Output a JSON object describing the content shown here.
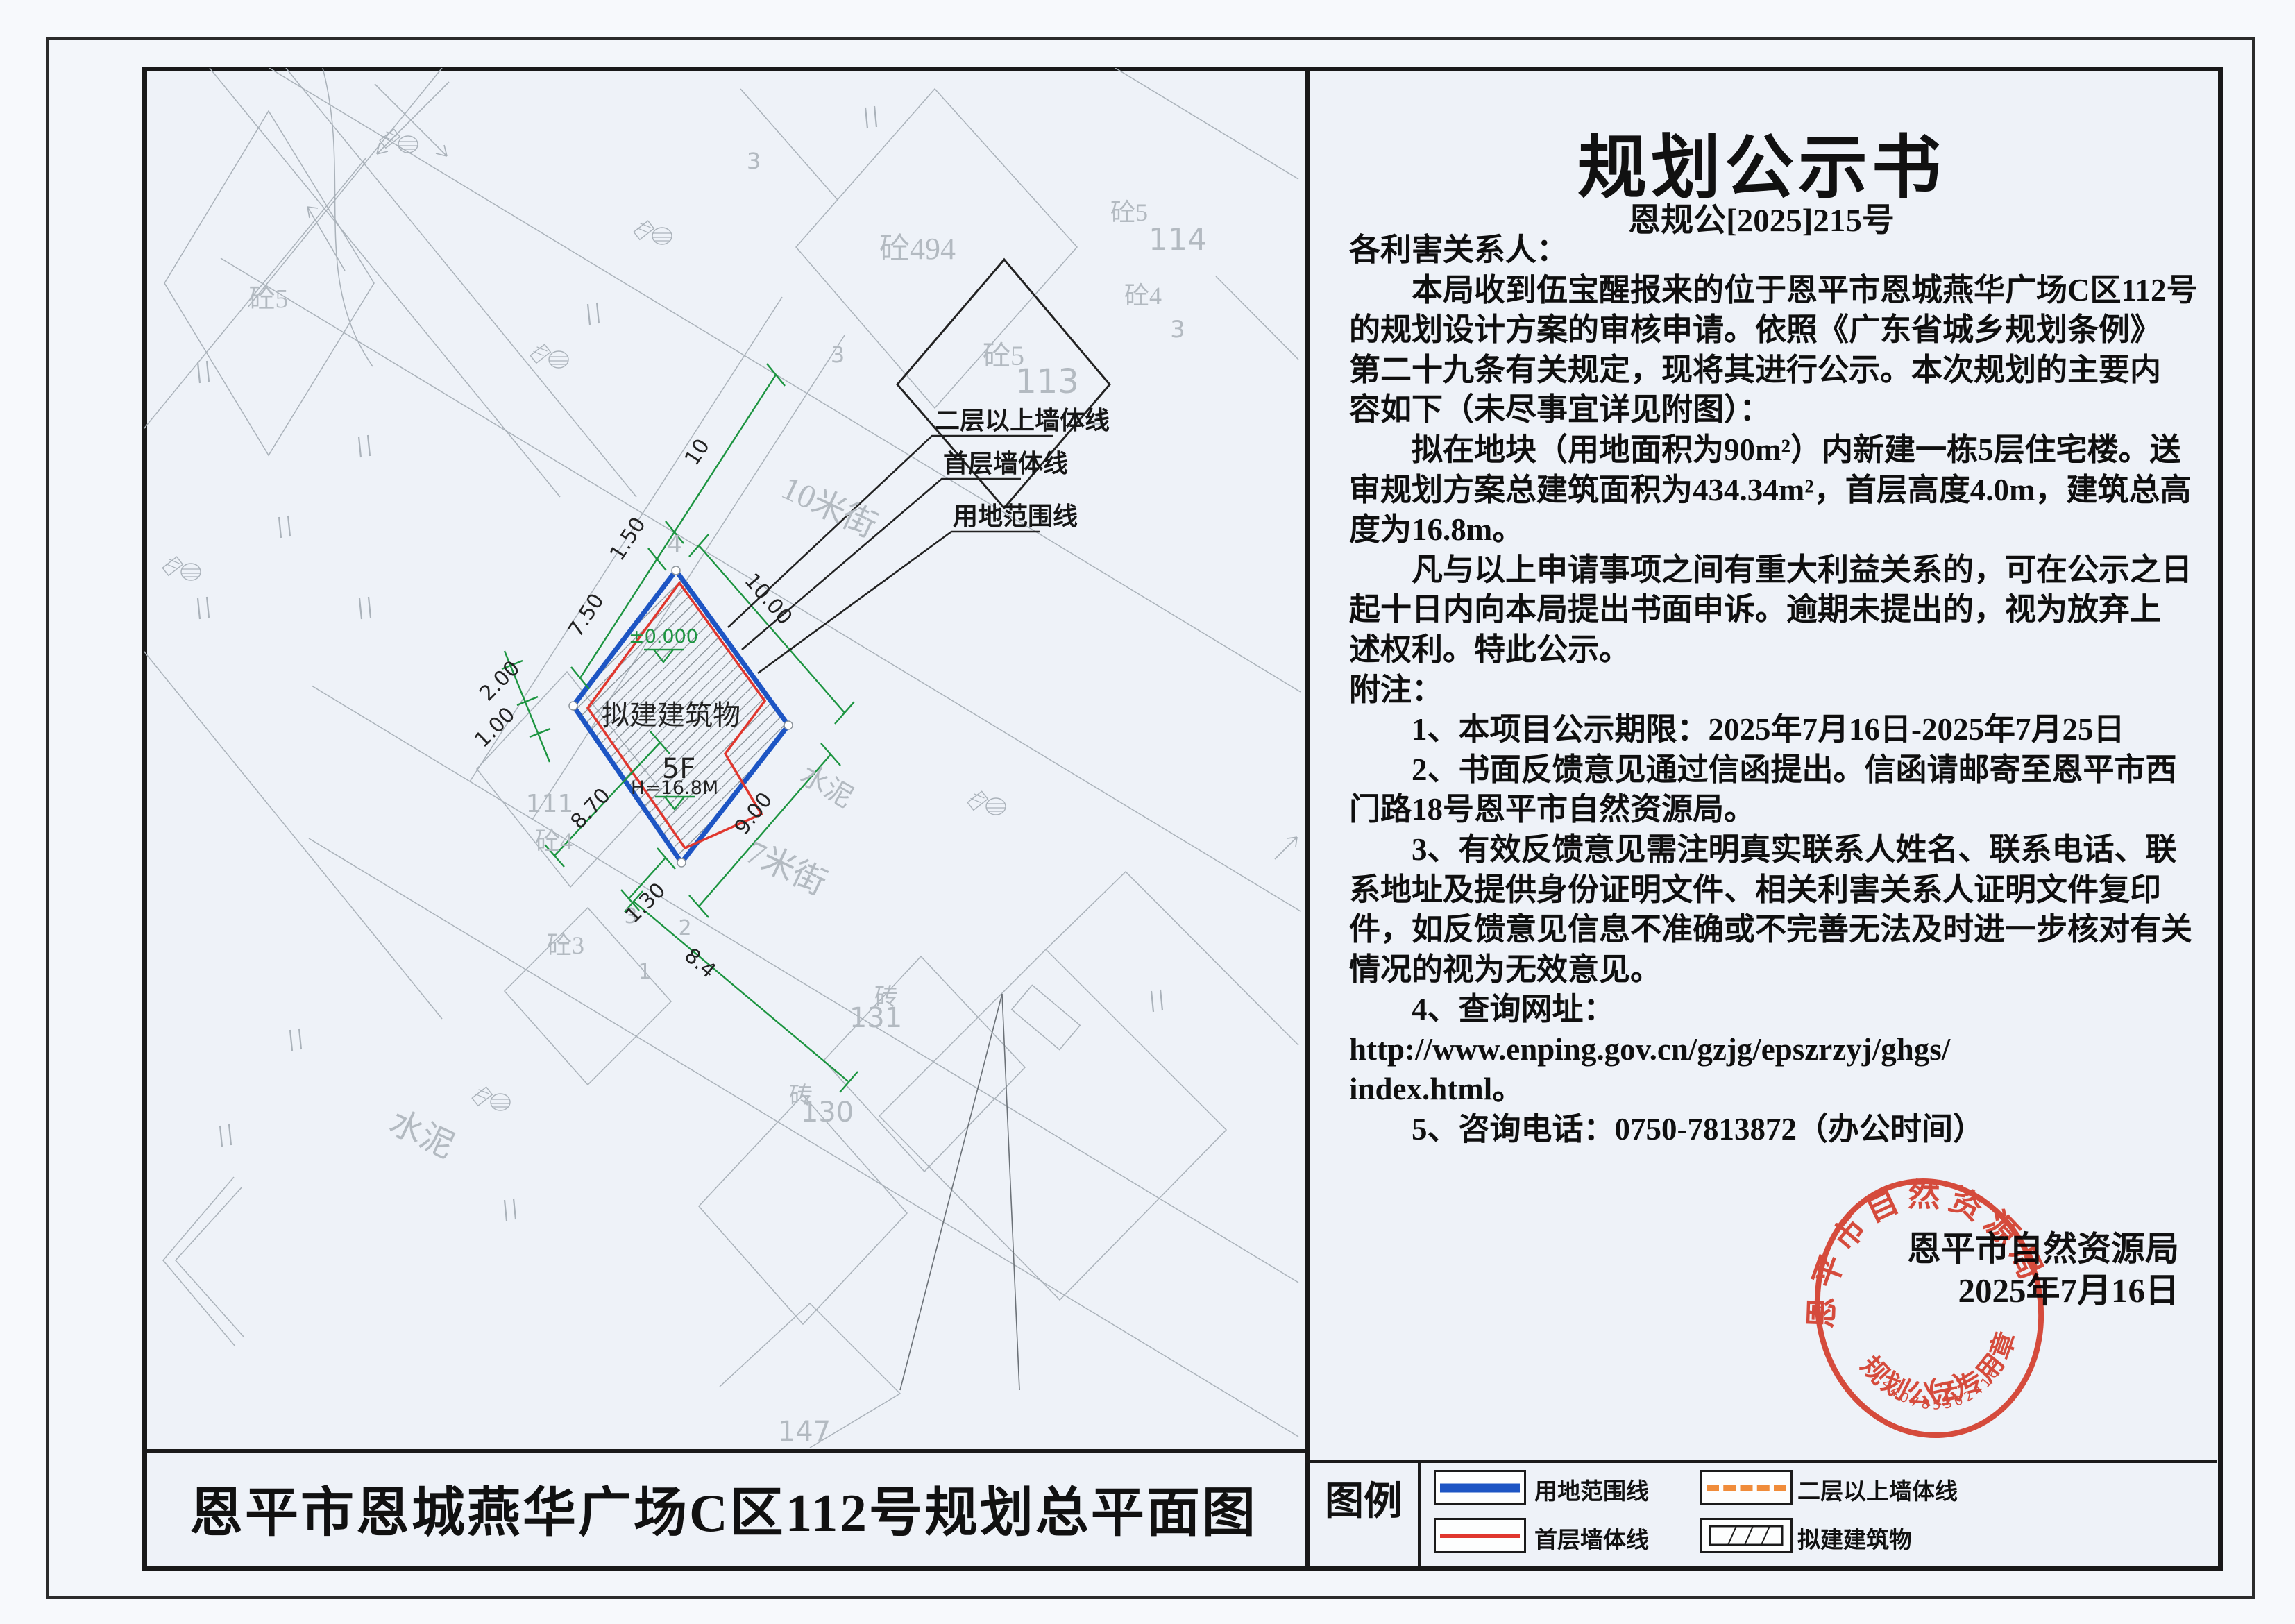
{
  "doc": {
    "title": "规划公示书",
    "doc_no": "恩规公[2025]215号",
    "lines": [
      "各利害关系人：",
      "　　本局收到伍宝醒报来的位于恩平市恩城燕华广场C区112号",
      "的规划设计方案的审核申请。依照《广东省城乡规划条例》",
      "第二十九条有关规定，现将其进行公示。本次规划的主要内",
      "容如下（未尽事宜详见附图）：",
      "　　拟在地块（用地面积为90m²）内新建一栋5层住宅楼。送",
      "审规划方案总建筑面积为434.34m²，首层高度4.0m，建筑总高",
      "度为16.8m。",
      "　　凡与以上申请事项之间有重大利益关系的，可在公示之日",
      "起十日内向本局提出书面申诉。逾期未提出的，视为放弃上",
      "述权利。特此公示。",
      "附注：",
      "　　1、本项目公示期限：2025年7月16日-2025年7月25日",
      "　　2、书面反馈意见通过信函提出。信函请邮寄至恩平市西",
      "门路18号恩平市自然资源局。",
      "　　3、有效反馈意见需注明真实联系人姓名、联系电话、联",
      "系地址及提供身份证明文件、相关利害关系人证明文件复印",
      "件，如反馈意见信息不准确或不完善无法及时进一步核对有关",
      "情况的视为无效意见。",
      "　　4、查询网址：",
      "http://www.enping.gov.cn/gzjg/epszrzyj/ghgs/",
      "index.html。",
      "　　5、咨询电话：0750-7813872（办公时间）"
    ],
    "sign_org": "恩平市自然资源局",
    "sign_date": "2025年7月16日"
  },
  "stamp": {
    "arc_top": "恩平市自然资源局",
    "arc_bottom": "规划公示专用章",
    "number_label": "（2）",
    "serial": "4407853024167"
  },
  "plan": {
    "title": "恩平市恩城燕华广场C区112号规划总平面图",
    "labels": {
      "z5_tl": "砼5",
      "z494": "砼494",
      "s3_a": "3",
      "s3_b": "3",
      "jie10": "10米街",
      "jie7": "7米街",
      "z5_big": "砼5",
      "n113": "113",
      "n4_big": "4",
      "z4_tr": "砼4",
      "n114": "114",
      "z5_tr": "砼5",
      "n3_tr": "3",
      "n4_top": "4",
      "bldg": "拟建建筑物",
      "f5": "5F",
      "h168": "H=16.8M",
      "elev": "±0.000",
      "n111": "111",
      "z4_l": "砼4",
      "z3_l": "砼3",
      "n3_l": "3",
      "n2_b": "2",
      "n1_b": "1",
      "sn_sm": "水泥",
      "sn_big": "水泥",
      "zh_a": "砖",
      "n131": "131",
      "zh_b": "砖",
      "n130": "130",
      "n147": "147"
    },
    "dims": {
      "d10": "10",
      "d150": "1.50",
      "d750": "7.50",
      "d1000": "10.00",
      "d900": "9.00",
      "d870": "8.70",
      "d200": "2.00",
      "d100": "1.00",
      "d130": "1.30",
      "d84": "8.4"
    },
    "leaders": {
      "l2f": "二层以上墙体线",
      "l1f": "首层墙体线",
      "lyd": "用地范围线"
    }
  },
  "legend": {
    "label": "图例",
    "items": [
      {
        "label": "用地范围线"
      },
      {
        "label": "二层以上墙体线"
      },
      {
        "label": "首层墙体线"
      },
      {
        "label": "拟建建筑物"
      }
    ]
  },
  "colors": {
    "boundary_blue": "#1d55c4",
    "wall_red": "#e0372e",
    "upper_dash_orange": "#f08c3a",
    "dim_green": "#1c9440",
    "stamp_red": "#e23b28"
  }
}
